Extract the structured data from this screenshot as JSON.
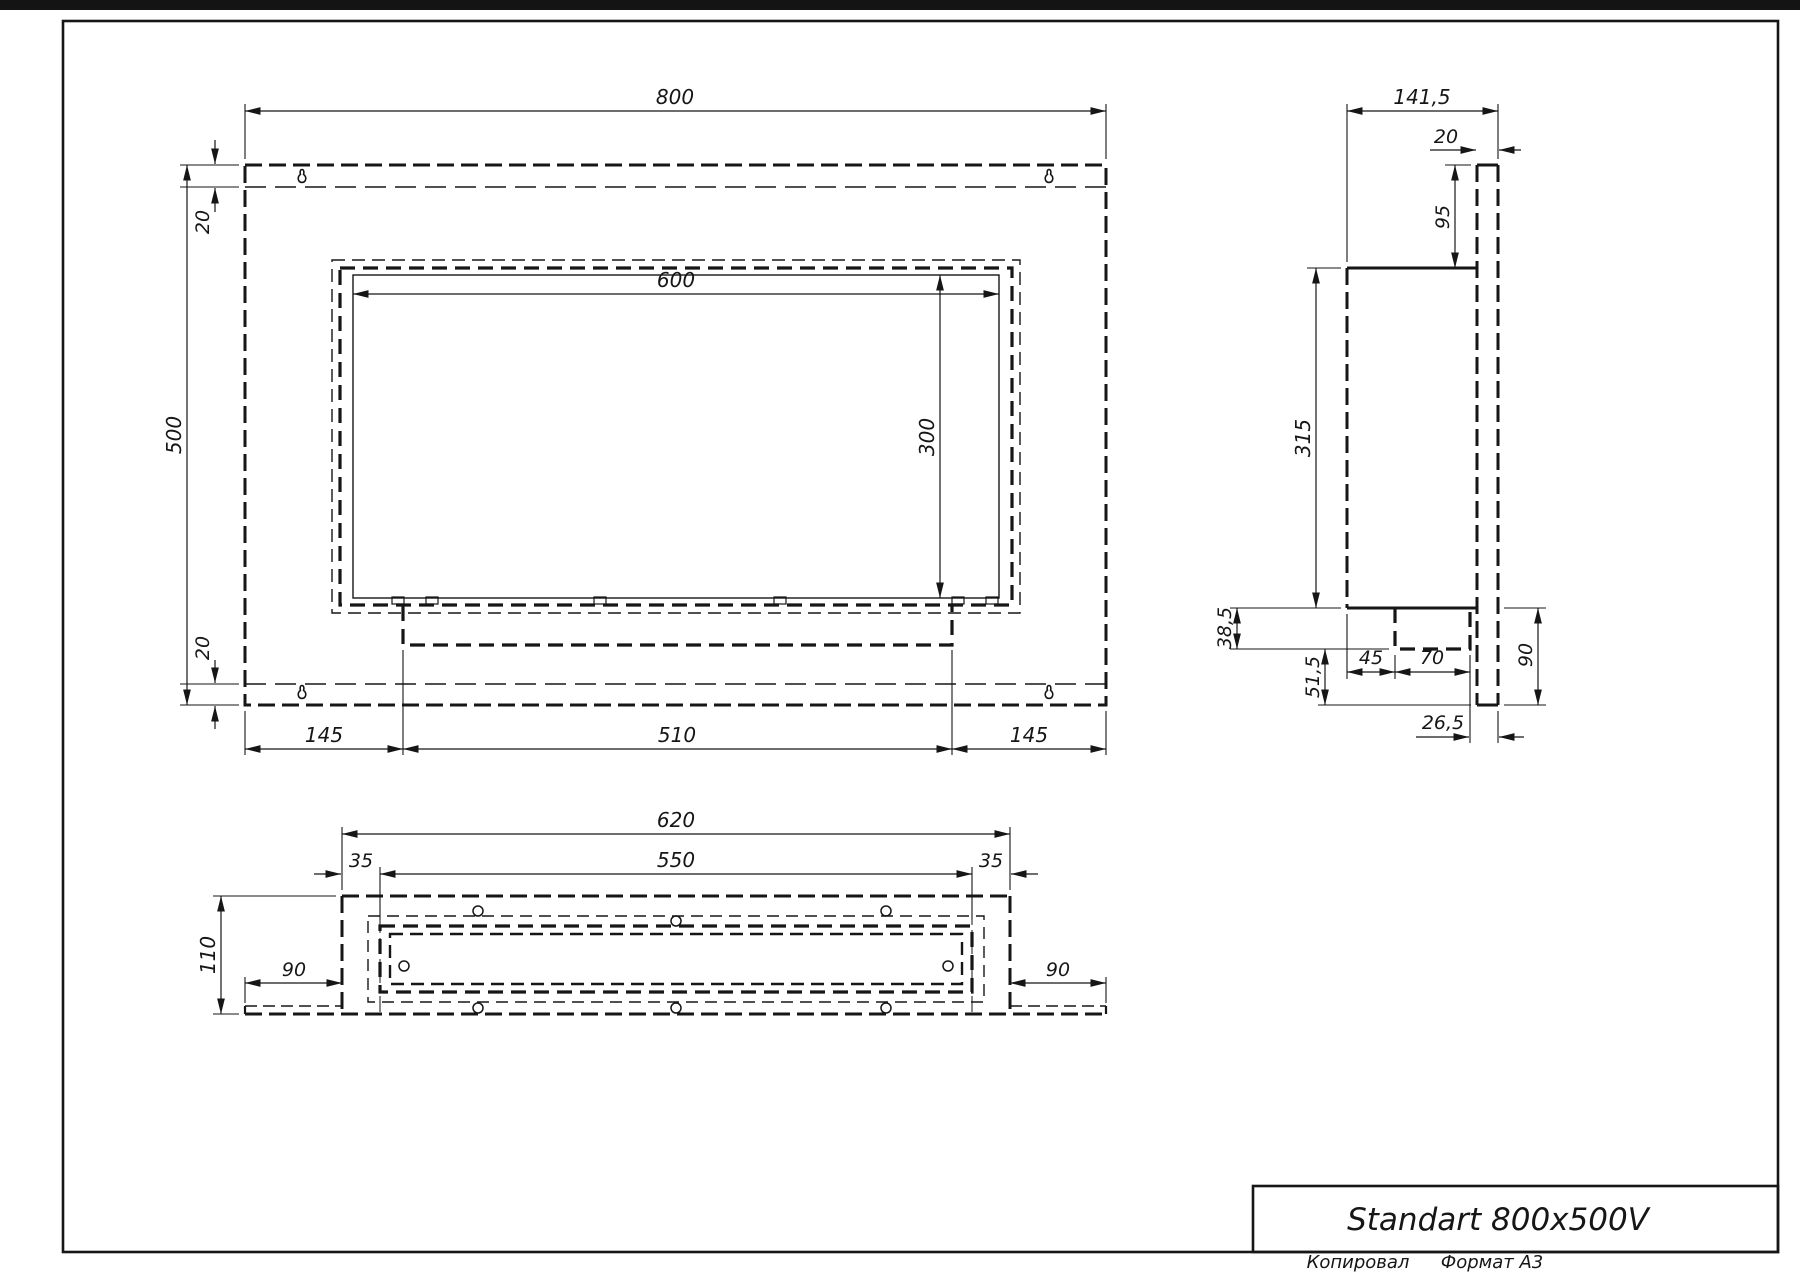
{
  "page": {
    "title": "Standart 800x500V",
    "footer_left": "Копировал",
    "footer_right": "Формат A3"
  },
  "dims": {
    "front": {
      "width": "800",
      "height": "500",
      "top_offset": "20",
      "bottom_offset": "20",
      "window_width": "600",
      "window_height": "300",
      "left_margin": "145",
      "tray_width": "510",
      "right_margin": "145"
    },
    "side": {
      "depth": "141,5",
      "plate_thickness": "20",
      "top_to_body": "95",
      "body_height": "315",
      "tray_drop": "38,5",
      "plate_below": "51,5",
      "body_to_tray": "45",
      "tray_depth": "70",
      "bottom_offset": "26,5",
      "plate_extension": "90"
    },
    "bottom": {
      "box_width": "620",
      "opening_width": "550",
      "left_inset": "35",
      "right_inset": "35",
      "depth": "110",
      "left_flange": "90",
      "right_flange": "90"
    }
  }
}
